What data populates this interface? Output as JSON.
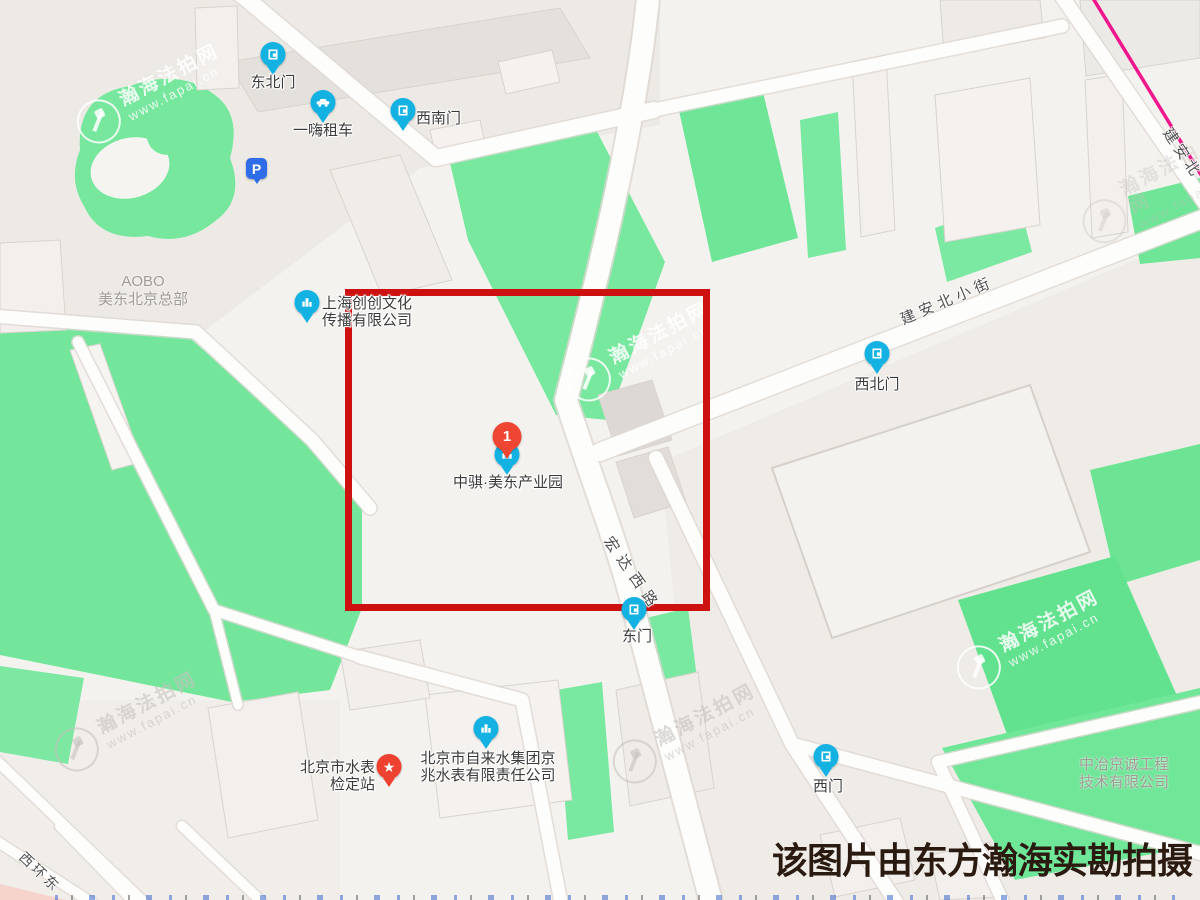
{
  "caption": "该图片由东方瀚海实勘拍摄",
  "watermark": {
    "brand": "瀚海法拍网",
    "site": "www.fapai.cn"
  },
  "pois": {
    "dongbeimen": {
      "label": "东北门"
    },
    "yihai": {
      "label": "一嗨租车"
    },
    "xinanmen": {
      "label": "西南门"
    },
    "xibeimen": {
      "label": "西北门"
    },
    "dongmen": {
      "label": "东门"
    },
    "ximen": {
      "label": "西门"
    },
    "shanghai_chuangchuang": {
      "line1": "上海创创文化",
      "line2": "传播有限公司"
    },
    "zhongqi": {
      "label": "中骐·美东产业园",
      "marker_number": "1"
    },
    "shuibiao_jiandingzhan": {
      "line1": "北京市水表",
      "line2": "检定站"
    },
    "zilaishui": {
      "line1": "北京市自来水集团京",
      "line2": "兆水表有限责任公司"
    },
    "parking": {
      "label": "P"
    }
  },
  "area_labels": {
    "aobo": {
      "line1": "AOBO",
      "line2": "美东北京总部"
    },
    "zhongye": {
      "line1": "中冶京诚工程",
      "line2": "技术有限公司"
    }
  },
  "road_labels": {
    "jiananbeixiaojie": "建安北小街",
    "hongdaxilu": "宏达西路",
    "jiananbei": "建安北",
    "xihuandong": "西环东"
  }
}
